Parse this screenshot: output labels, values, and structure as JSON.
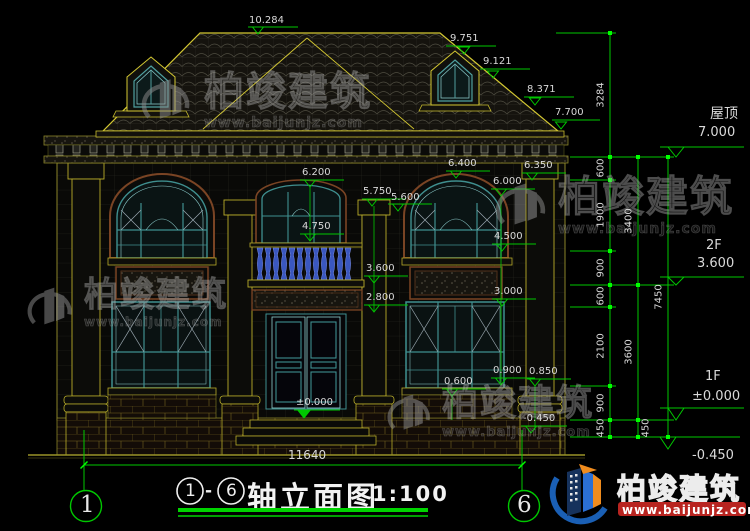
{
  "dims": {
    "peak": "10.284",
    "slope1": "9.751",
    "slope2": "9.121",
    "slope3": "8.371",
    "eave": "7.700",
    "c_6200": "6.200",
    "c_5750": "5.750",
    "c_5600": "5.600",
    "c_4750": "4.750",
    "c_3600": "3.600",
    "c_2800": "2.800",
    "door_zero": "±0.000",
    "r_6400": "6.400",
    "r_6350": "6.350",
    "r_6000": "6.000",
    "r_4500": "4.500",
    "r_3000": "3.000",
    "b_0900": "0.900",
    "b_0850": "0.850",
    "b_0600": "0.600",
    "b_neg450": "-0.450",
    "overall_width": "11640"
  },
  "chains": {
    "inner": [
      "3284",
      "600",
      "1900",
      "900",
      "600",
      "2100",
      "900",
      "450"
    ],
    "mid": [
      "3400",
      "3600",
      "450"
    ],
    "outer": [
      "7450"
    ]
  },
  "levels": {
    "roof_label": "屋顶",
    "roof_value": "7.000",
    "f2_label": "2F",
    "f2_value": "3.600",
    "f1_label": "1F",
    "f1_value": "±0.000",
    "base_value": "-0.450"
  },
  "axes": {
    "left": "1",
    "right": "6"
  },
  "title": {
    "bubble_start": "1",
    "separator": "-",
    "bubble_end": "6",
    "name": "轴立面图",
    "scale": "1:100"
  },
  "brand": {
    "name": "柏竣建筑",
    "url": "www.baijunjz.com"
  },
  "colors": {
    "dim_green": "#00c800",
    "tick_green": "#00ff00",
    "line_yellow": "#c8b432",
    "window_teal": "#3f8f8f",
    "baluster_blue": "#3a57c0",
    "brand_blue": "#1a5fb4",
    "brand_orange": "#f08c1e",
    "text_white": "#d9d9d9"
  }
}
